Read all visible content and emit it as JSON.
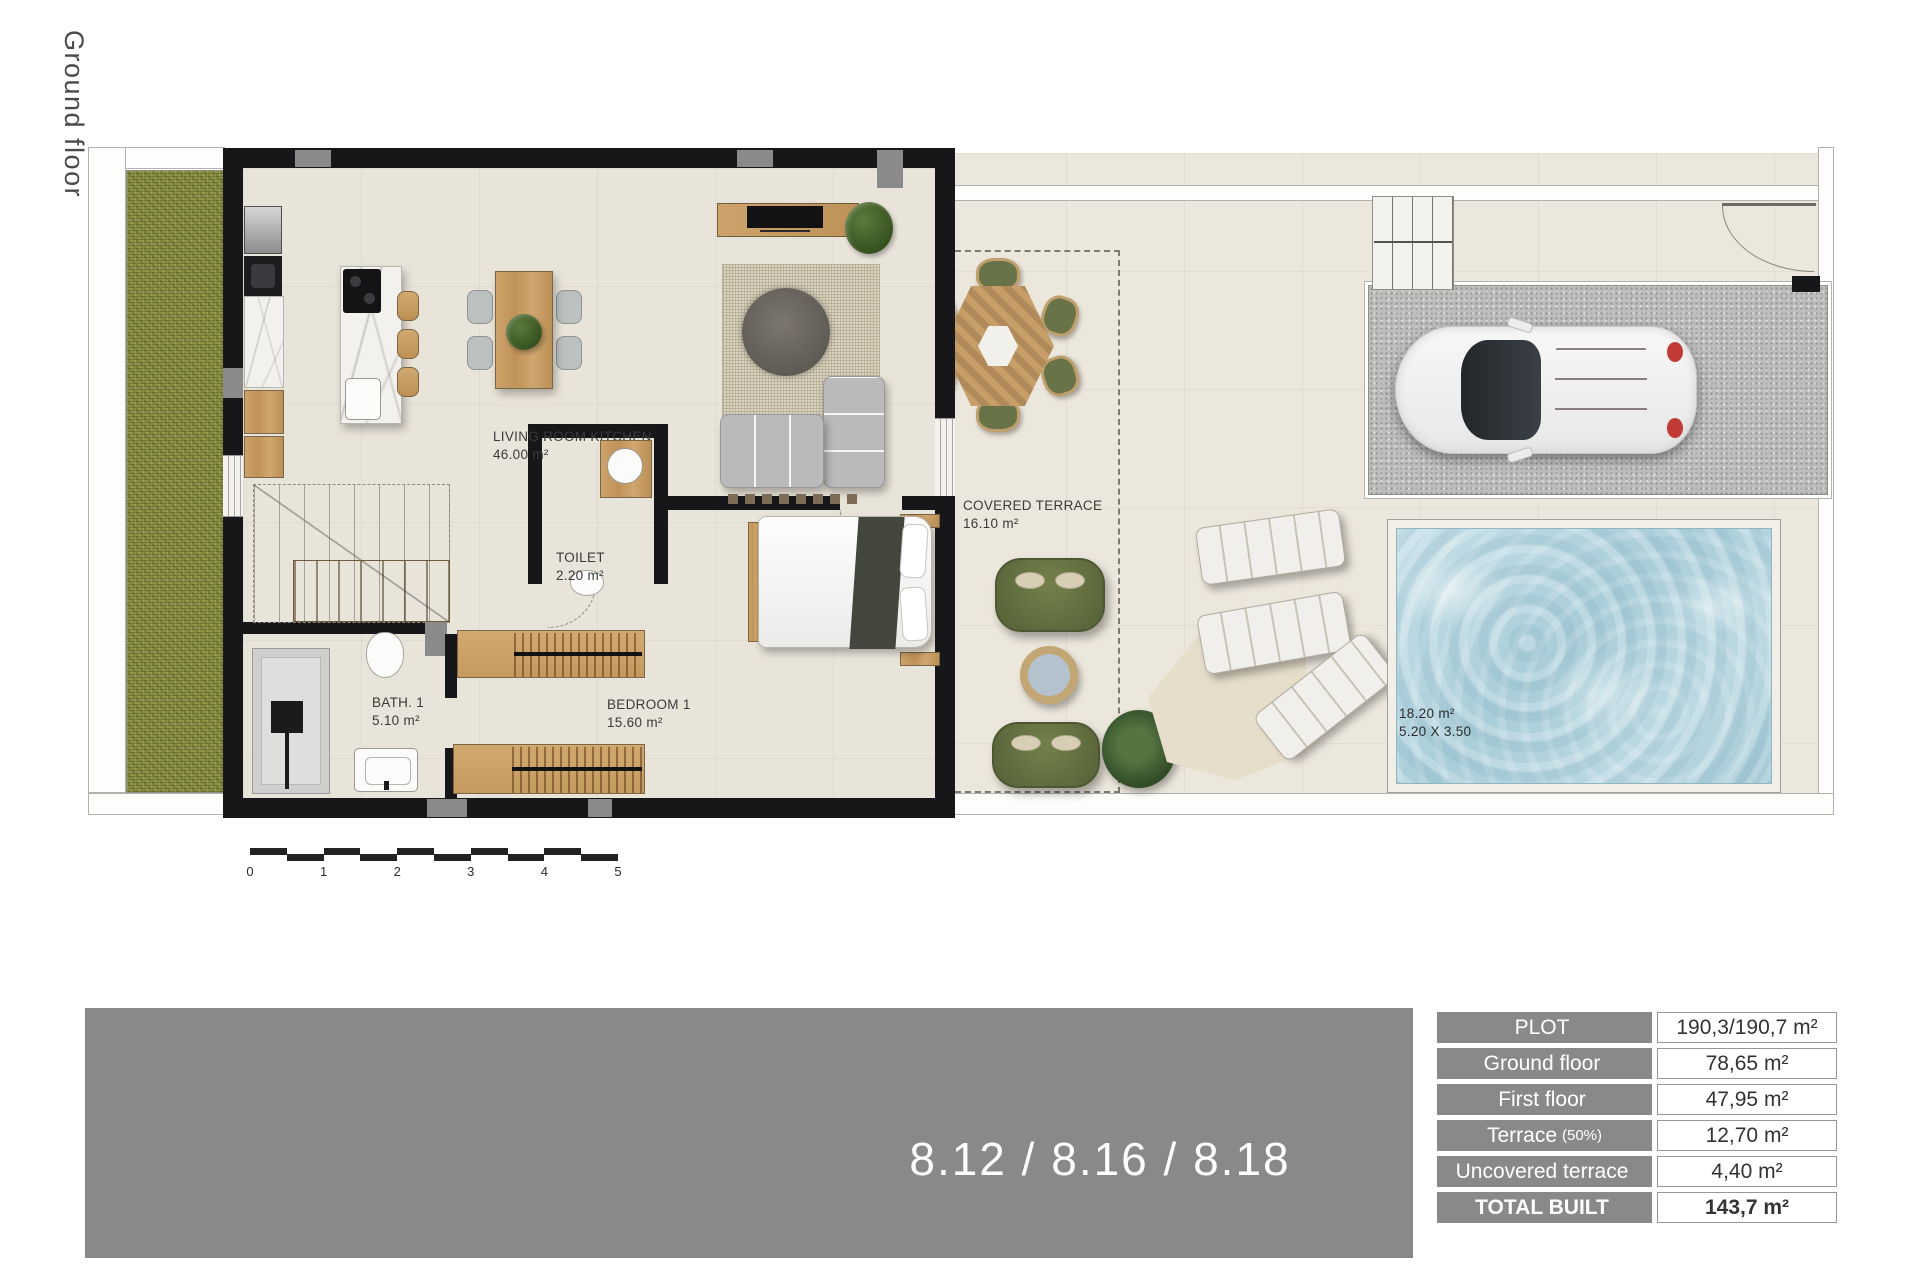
{
  "page": {
    "vertical_title": "Ground floor"
  },
  "colors": {
    "wall": "#17171a",
    "interior_floor": "#e9e4d9",
    "terrace_floor": "#ece7dc",
    "grass": "#8a8f42",
    "pool_water": "#aecfdb",
    "wood": "#cda36b",
    "panel_gray": "#8b8889",
    "sofa_gray": "#bababa",
    "outdoor_sofa_green": "#687447",
    "car_accent_red": "#94494f"
  },
  "plan": {
    "rooms": {
      "living": {
        "name": "LIVING ROOM KITCHEN",
        "area": "46.00 m²"
      },
      "toilet": {
        "name": "TOILET",
        "area": "2.20 m²"
      },
      "bath": {
        "name": "BATH. 1",
        "area": "5.10 m²"
      },
      "bedroom": {
        "name": "BEDROOM 1",
        "area": "15.60 m²"
      },
      "covered_terrace": {
        "name": "COVERED TERRACE",
        "area": "16.10 m²"
      },
      "pool": {
        "area": "18.20 m²",
        "dimensions": "5.20 X 3.50"
      }
    },
    "scale_bar": {
      "ticks": [
        "0",
        "1",
        "2",
        "3",
        "4",
        "5"
      ]
    }
  },
  "footer": {
    "unit_numbers": "8.12 / 8.16 / 8.18"
  },
  "areas_table": {
    "rows": [
      {
        "label": "PLOT",
        "suffix": "",
        "value": "190,3/190,7 m²"
      },
      {
        "label": "Ground floor",
        "suffix": "",
        "value": "78,65 m²"
      },
      {
        "label": "First floor",
        "suffix": "",
        "value": "47,95 m²"
      },
      {
        "label": "Terrace",
        "suffix": "(50%)",
        "value": "12,70 m²"
      },
      {
        "label": "Uncovered terrace",
        "suffix": "",
        "value": "4,40 m²"
      },
      {
        "label": "TOTAL BUILT",
        "suffix": "",
        "value": "143,7 m²"
      }
    ]
  }
}
